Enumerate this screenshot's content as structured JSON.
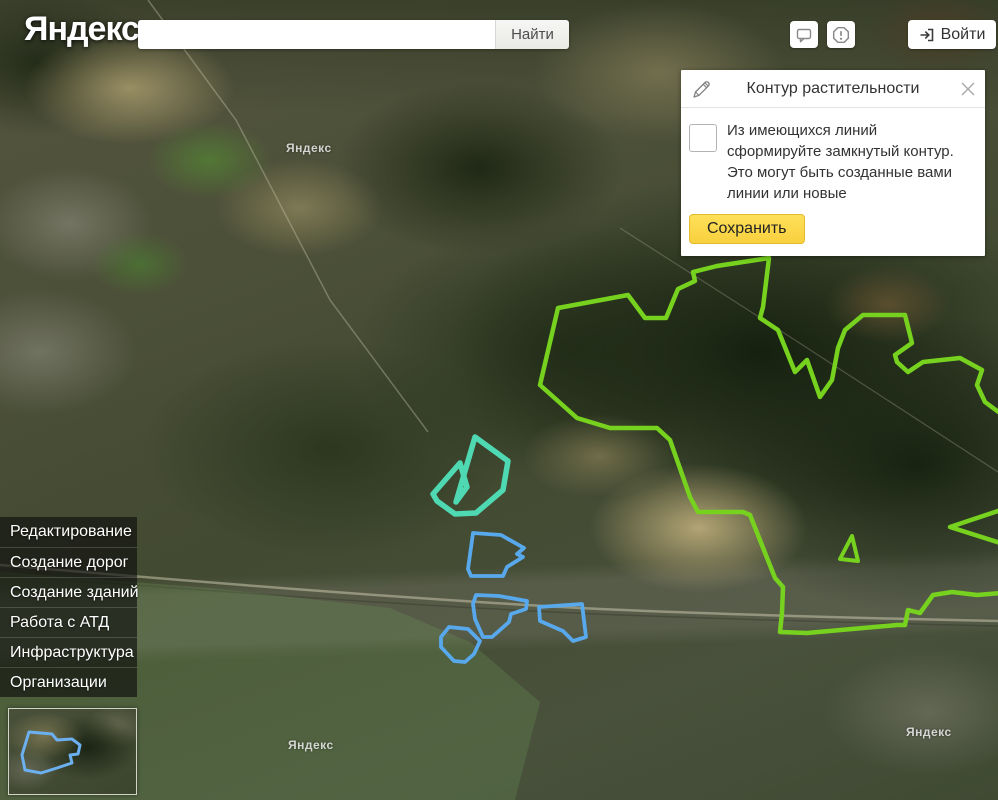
{
  "page": {
    "logo": "Яндекс"
  },
  "search": {
    "value": "",
    "placeholder": "",
    "button_label": "Найти"
  },
  "topbar": {
    "login_label": "Войти"
  },
  "panel": {
    "title": "Контур растительности",
    "description": "Из имеющихся линий сформируйте замкнутый контур. Это могут быть созданные вами линии или новые",
    "save_label": "Сохранить",
    "checkbox_checked": false
  },
  "sidebar": {
    "items": [
      "Редактирование",
      "Создание дорог",
      "Создание зданий",
      "Работа с АТД",
      "Инфраструктура",
      "Организации"
    ]
  },
  "map": {
    "watermark": "Яндекс",
    "colors": {
      "vegetation_contour": "#76d21e",
      "active_contour": "#4fd9b2",
      "water_contour": "#58a8ec",
      "minimap_contour": "#6cb0f0"
    }
  }
}
